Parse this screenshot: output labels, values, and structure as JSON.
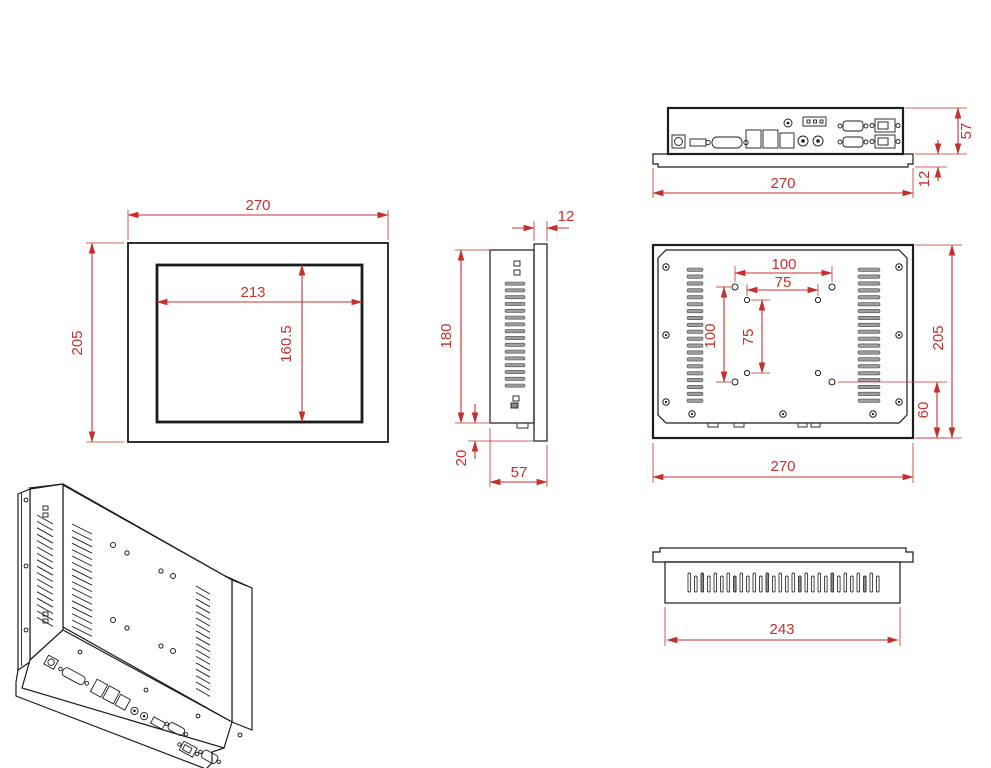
{
  "drawing": {
    "colors": {
      "line": "#1c1c1c",
      "dimension": "#c5302c",
      "vent_fill": "#9e9e9e",
      "background": "#ffffff"
    },
    "views": {
      "top_io": {
        "dims": {
          "width": "270",
          "depth": "57",
          "flange": "12"
        }
      },
      "front": {
        "dims": {
          "width": "270",
          "height": "205",
          "screen_width": "213",
          "screen_height": "160.5"
        }
      },
      "side": {
        "dims": {
          "flange": "12",
          "body_height": "180",
          "bottom_offset": "20",
          "depth": "57"
        }
      },
      "rear": {
        "dims": {
          "width": "270",
          "height": "205",
          "vesa_width_100": "100",
          "vesa_width_75": "75",
          "vesa_height_100": "100",
          "vesa_height_75": "75",
          "bottom_offset": "60"
        }
      },
      "bottom": {
        "dims": {
          "body_width": "243"
        }
      }
    }
  }
}
